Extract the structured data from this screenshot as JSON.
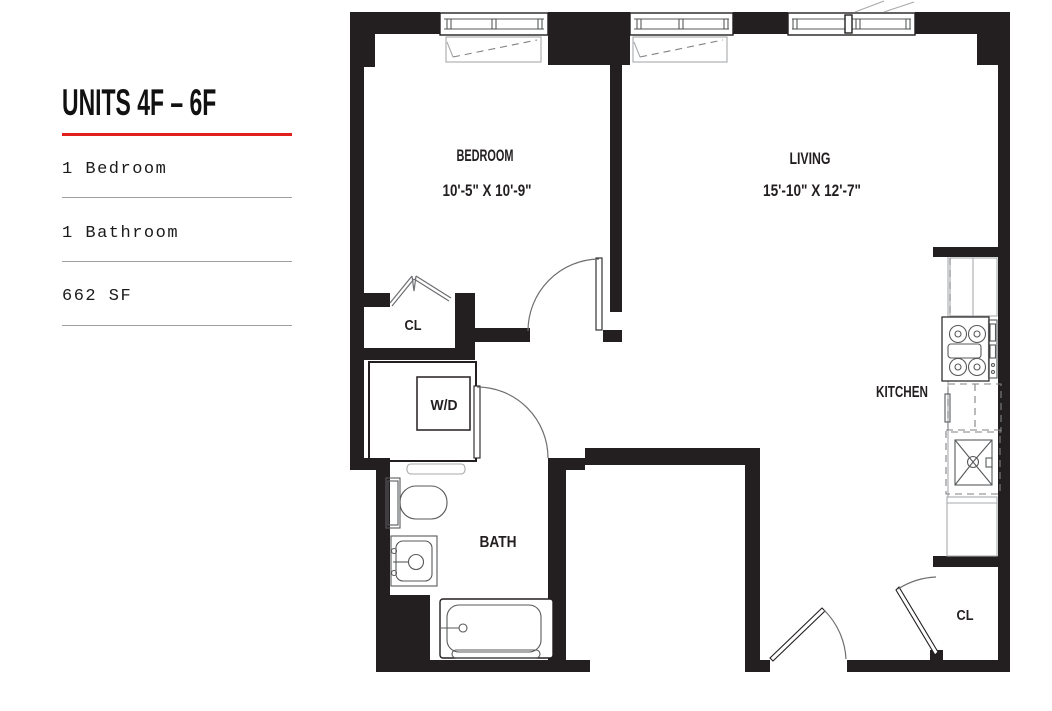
{
  "sidebar": {
    "title": "UNITS 4F – 6F",
    "accent_color": "#e0201d",
    "specs": [
      {
        "label": "1 Bedroom"
      },
      {
        "label": "1 Bathroom"
      },
      {
        "label": "662 SF"
      }
    ]
  },
  "floorplan": {
    "wall_color": "#231f20",
    "line_color": "#58595b",
    "rooms": [
      {
        "name": "BEDROOM",
        "dimensions": "10'-5\" X 10'-9\""
      },
      {
        "name": "LIVING",
        "dimensions": "15'-10\" X 12'-7\""
      },
      {
        "name": "KITCHEN"
      },
      {
        "name": "BATH"
      }
    ],
    "closets": [
      {
        "label": "CL"
      },
      {
        "label": "CL"
      }
    ],
    "laundry": {
      "label": "W/D"
    }
  }
}
